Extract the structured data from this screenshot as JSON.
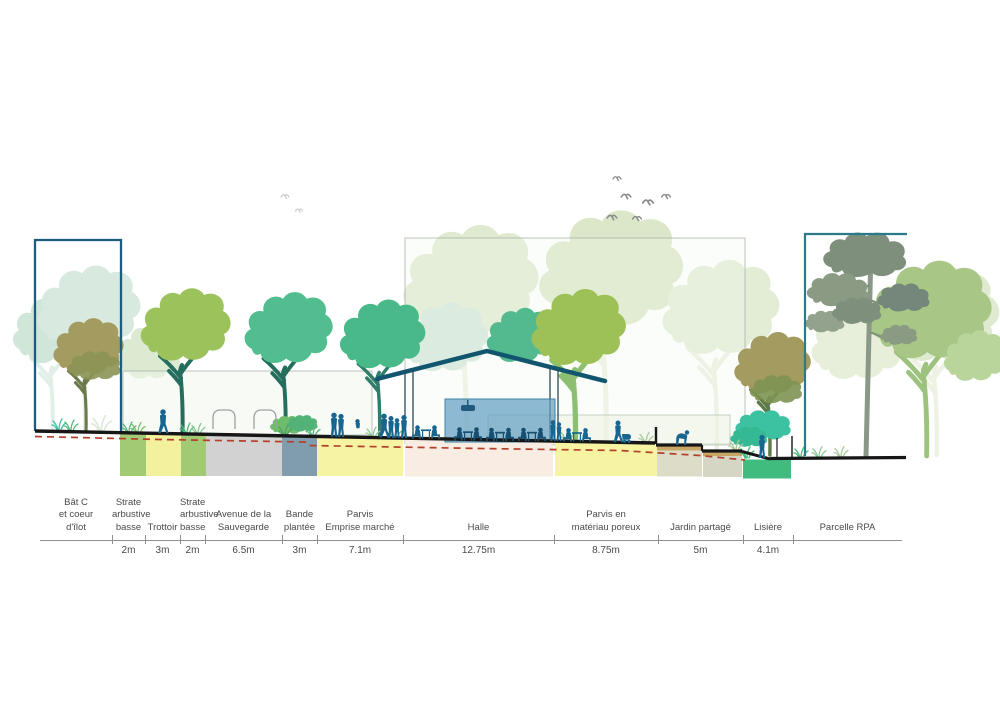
{
  "page": {
    "type": "landscape-architecture-section",
    "background": "#ffffff"
  },
  "colors": {
    "building_outline_left": "#1d5c7c",
    "building_outline_right": "#2a7b8a",
    "halle_roof": "#11566e",
    "halle_kiosk_fill": "#63a0c2",
    "people_blue": "#186590",
    "ground_line": "#161616",
    "groundwater_dashed_red": "#b5402e",
    "soil_yellow": "#f6f3a2",
    "soil_green": "#a2c973",
    "soil_gray": "#d2d2d2",
    "soil_slate_blue": "#7f9dad",
    "soil_pink": "#f9ece2",
    "soil_lisiere_green": "#3fbc7e",
    "deck_tan": "#c8a766",
    "tree_yellow_green": "#9cc25c",
    "tree_teal_green": "#52bd8e",
    "tree_olive": "#a39b5f",
    "pine_gray_green": "#7e907c",
    "backdrop_pale_green": "#dce8cb",
    "backdrop_pale_mint": "#d8eae0"
  },
  "dimension_line": {
    "unit": "m",
    "segments": [
      {
        "label": "Bât C\net coeur\nd'îlot",
        "dim": null,
        "x0": 40,
        "x1": 112
      },
      {
        "label": "Strate\narbustive\nbasse",
        "dim": "2m",
        "x0": 112,
        "x1": 145
      },
      {
        "label": "Trottoir",
        "dim": "3m",
        "x0": 145,
        "x1": 180
      },
      {
        "label": "Strate\narbustive\nbasse",
        "dim": "2m",
        "x0": 180,
        "x1": 205
      },
      {
        "label": "Avenue de la\nSauvegarde",
        "dim": "6.5m",
        "x0": 205,
        "x1": 282
      },
      {
        "label": "Bande\nplantée",
        "dim": "3m",
        "x0": 282,
        "x1": 317
      },
      {
        "label": "Parvis\nEmprise marché",
        "dim": "7.1m",
        "x0": 317,
        "x1": 403
      },
      {
        "label": "Halle",
        "dim": "12.75m",
        "x0": 403,
        "x1": 554
      },
      {
        "label": "Parvis en\nmatériau poreux",
        "dim": "8.75m",
        "x0": 554,
        "x1": 658
      },
      {
        "label": "Jardin partagé",
        "dim": "5m",
        "x0": 658,
        "x1": 743
      },
      {
        "label": "Lisière",
        "dim": "4.1m",
        "x0": 743,
        "x1": 793
      },
      {
        "label": "Parcelle RPA",
        "dim": null,
        "x0": 793,
        "x1": 902
      }
    ]
  },
  "scene": {
    "elements": [
      "backdrop-trees",
      "bat-c-building-outline",
      "coeur-d-ilot-vegetation",
      "street-trees",
      "glass-panels",
      "halle-roof",
      "halle-posts",
      "halle-kiosk",
      "market-tables",
      "pedestrians",
      "cyclist",
      "stroller-person",
      "cars",
      "gardener",
      "terraced-steps",
      "lisiere-shrubs",
      "pine-tree",
      "parcelle-rpa-outline",
      "bird-flocks",
      "soil-bands",
      "groundwater-dashed-line"
    ]
  }
}
